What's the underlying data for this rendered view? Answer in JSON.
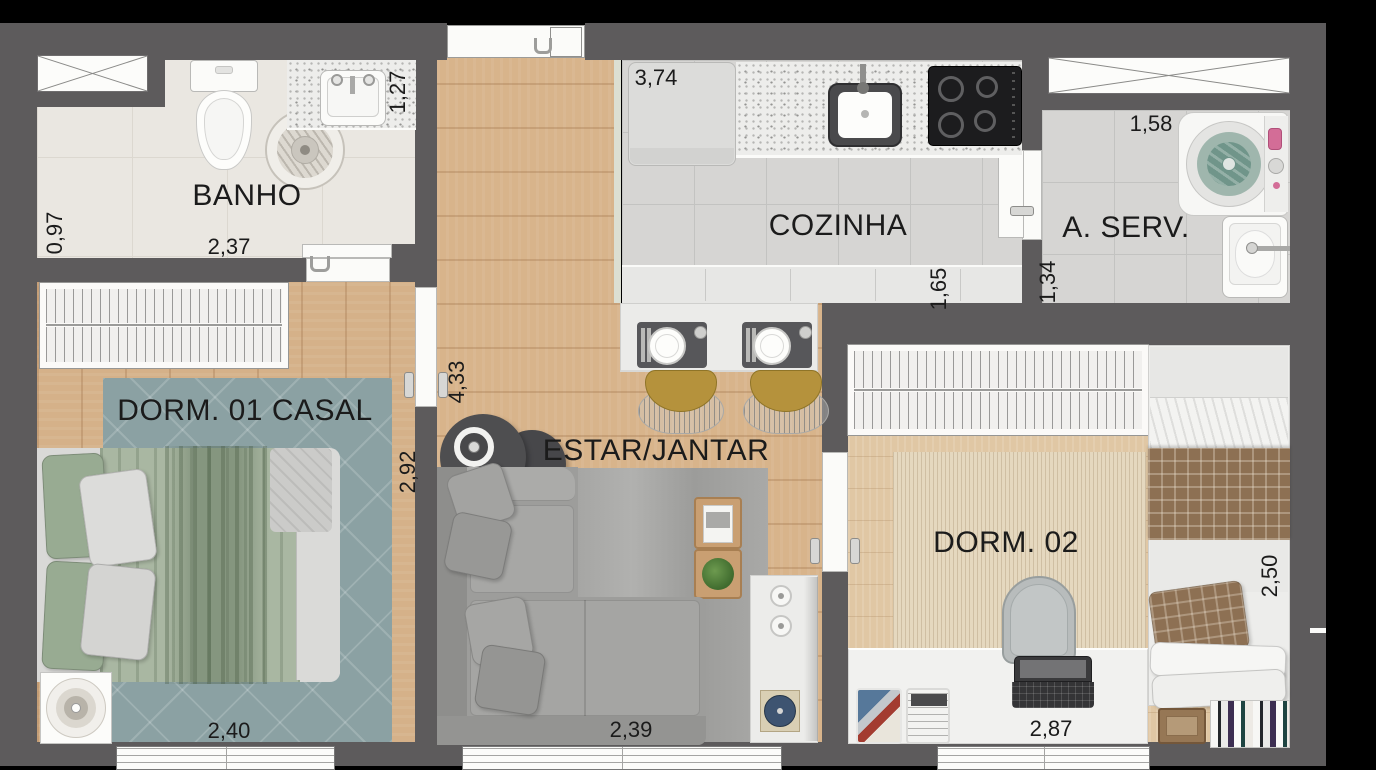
{
  "plan": {
    "type": "apartment-floor-plan",
    "rooms": {
      "banho": "BANHO",
      "cozinha": "COZINHA",
      "aserv": "A. SERV.",
      "dorm1": "DORM. 01 CASAL",
      "estar": "ESTAR/JANTAR",
      "dorm2": "DORM. 02"
    },
    "dimensions": {
      "banho_depth": "0,97",
      "banho_width": "2,37",
      "banho_side": "1,27",
      "cozinha_width": "3,74",
      "cozinha_depth": "1,65",
      "aserv_width": "1,58",
      "aserv_depth": "1,34",
      "hall_length": "4,33",
      "dorm1_depth": "2,92",
      "dorm1_width": "2,40",
      "estar_width": "2,39",
      "dorm2_depth": "2,50",
      "dorm2_width": "2,87"
    },
    "colors": {
      "background": "#000000",
      "wall": "#5d5b5c",
      "wood_floor": "#d8b48b",
      "wood_floor_dorm2": "#e0c7a4",
      "tile_bath": "#eae7e1",
      "tile_kitchen": "#d6d5d3",
      "rug_dorm1_teal": "#8ba1a3",
      "rug_estar_gray": "#a7a7a5",
      "rug_dorm2_beige": "#e5d8bf",
      "bed_green": "#a9b7a2",
      "stool_gold": "#b5923c",
      "plaid_brown": "#8d7053",
      "record_blue": "#3e5471",
      "washer_drum_teal": "#70958a"
    }
  }
}
